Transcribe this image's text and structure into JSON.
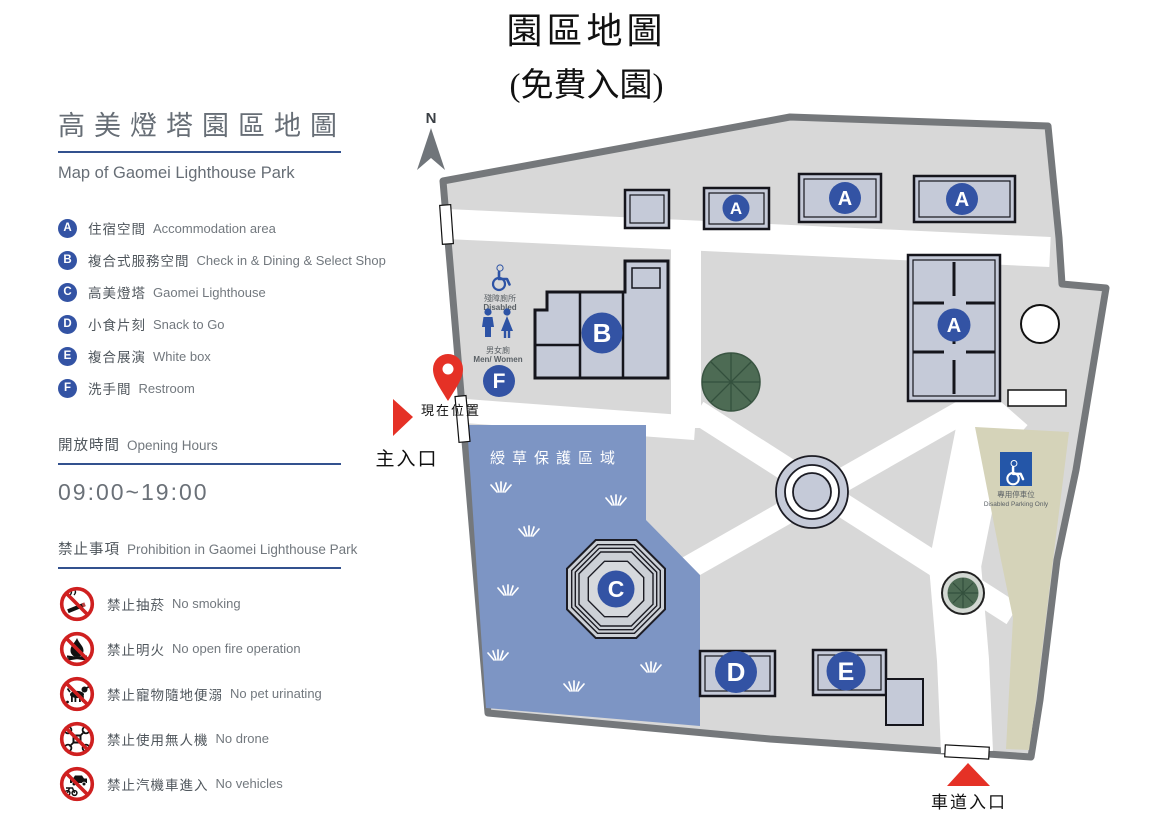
{
  "page_title": {
    "line1": "園區地圖",
    "line2": "(免費入園)"
  },
  "sidebar": {
    "title_zh": "高美燈塔園區地圖",
    "title_en": "Map of Gaomei Lighthouse Park",
    "legend": [
      {
        "key": "A",
        "zh": "住宿空間",
        "en": "Accommodation area"
      },
      {
        "key": "B",
        "zh": "複合式服務空間",
        "en": "Check in & Dining & Select Shop"
      },
      {
        "key": "C",
        "zh": "高美燈塔",
        "en": "Gaomei Lighthouse"
      },
      {
        "key": "D",
        "zh": "小食片刻",
        "en": "Snack to Go"
      },
      {
        "key": "E",
        "zh": "複合展演",
        "en": "White box"
      },
      {
        "key": "F",
        "zh": "洗手間",
        "en": "Restroom"
      }
    ],
    "opening_hours": {
      "zh": "開放時間",
      "en": "Opening Hours",
      "value": "09:00~19:00"
    },
    "prohibition": {
      "zh": "禁止事項",
      "en": "Prohibition in Gaomei Lighthouse Park",
      "items": [
        {
          "icon": "no-smoking",
          "zh": "禁止抽菸",
          "en": "No smoking"
        },
        {
          "icon": "no-open-fire",
          "zh": "禁止明火",
          "en": "No open fire operation"
        },
        {
          "icon": "no-pet-urinating",
          "zh": "禁止寵物隨地便溺",
          "en": "No pet urinating"
        },
        {
          "icon": "no-drone",
          "zh": "禁止使用無人機",
          "en": "No drone"
        },
        {
          "icon": "no-vehicles",
          "zh": "禁止汽機車進入",
          "en": "No vehicles"
        }
      ]
    }
  },
  "map": {
    "compass": "N",
    "main_entrance": "主入口",
    "current_location": "現在位置",
    "vehicle_entrance": "車道入口",
    "grass_area": "綬草保護區域",
    "restroom_signs": {
      "disabled_zh": "殘障廁所",
      "disabled_en": "Disabled",
      "mw_zh": "男女廁",
      "mw_en": "Men/ Women"
    },
    "parking": {
      "zh": "專用停車位",
      "en": "Disabled Parking Only"
    },
    "badges": {
      "a": "A",
      "b": "B",
      "c": "C",
      "d": "D",
      "e": "E",
      "f": "F"
    }
  },
  "colors": {
    "badge_blue": "#3353a4",
    "underline_blue": "#33518e",
    "prohibit_red": "#cf2020",
    "marker_red": "#e53126",
    "map_border": "#75787b",
    "map_fill": "#d8d8d8",
    "building_fill": "#c5cad8",
    "grass_blue": "#7d95c4",
    "parking_beige": "#d5d3b9",
    "tree_green": "#4d6b54",
    "restroom_blue": "#2d53a5"
  }
}
